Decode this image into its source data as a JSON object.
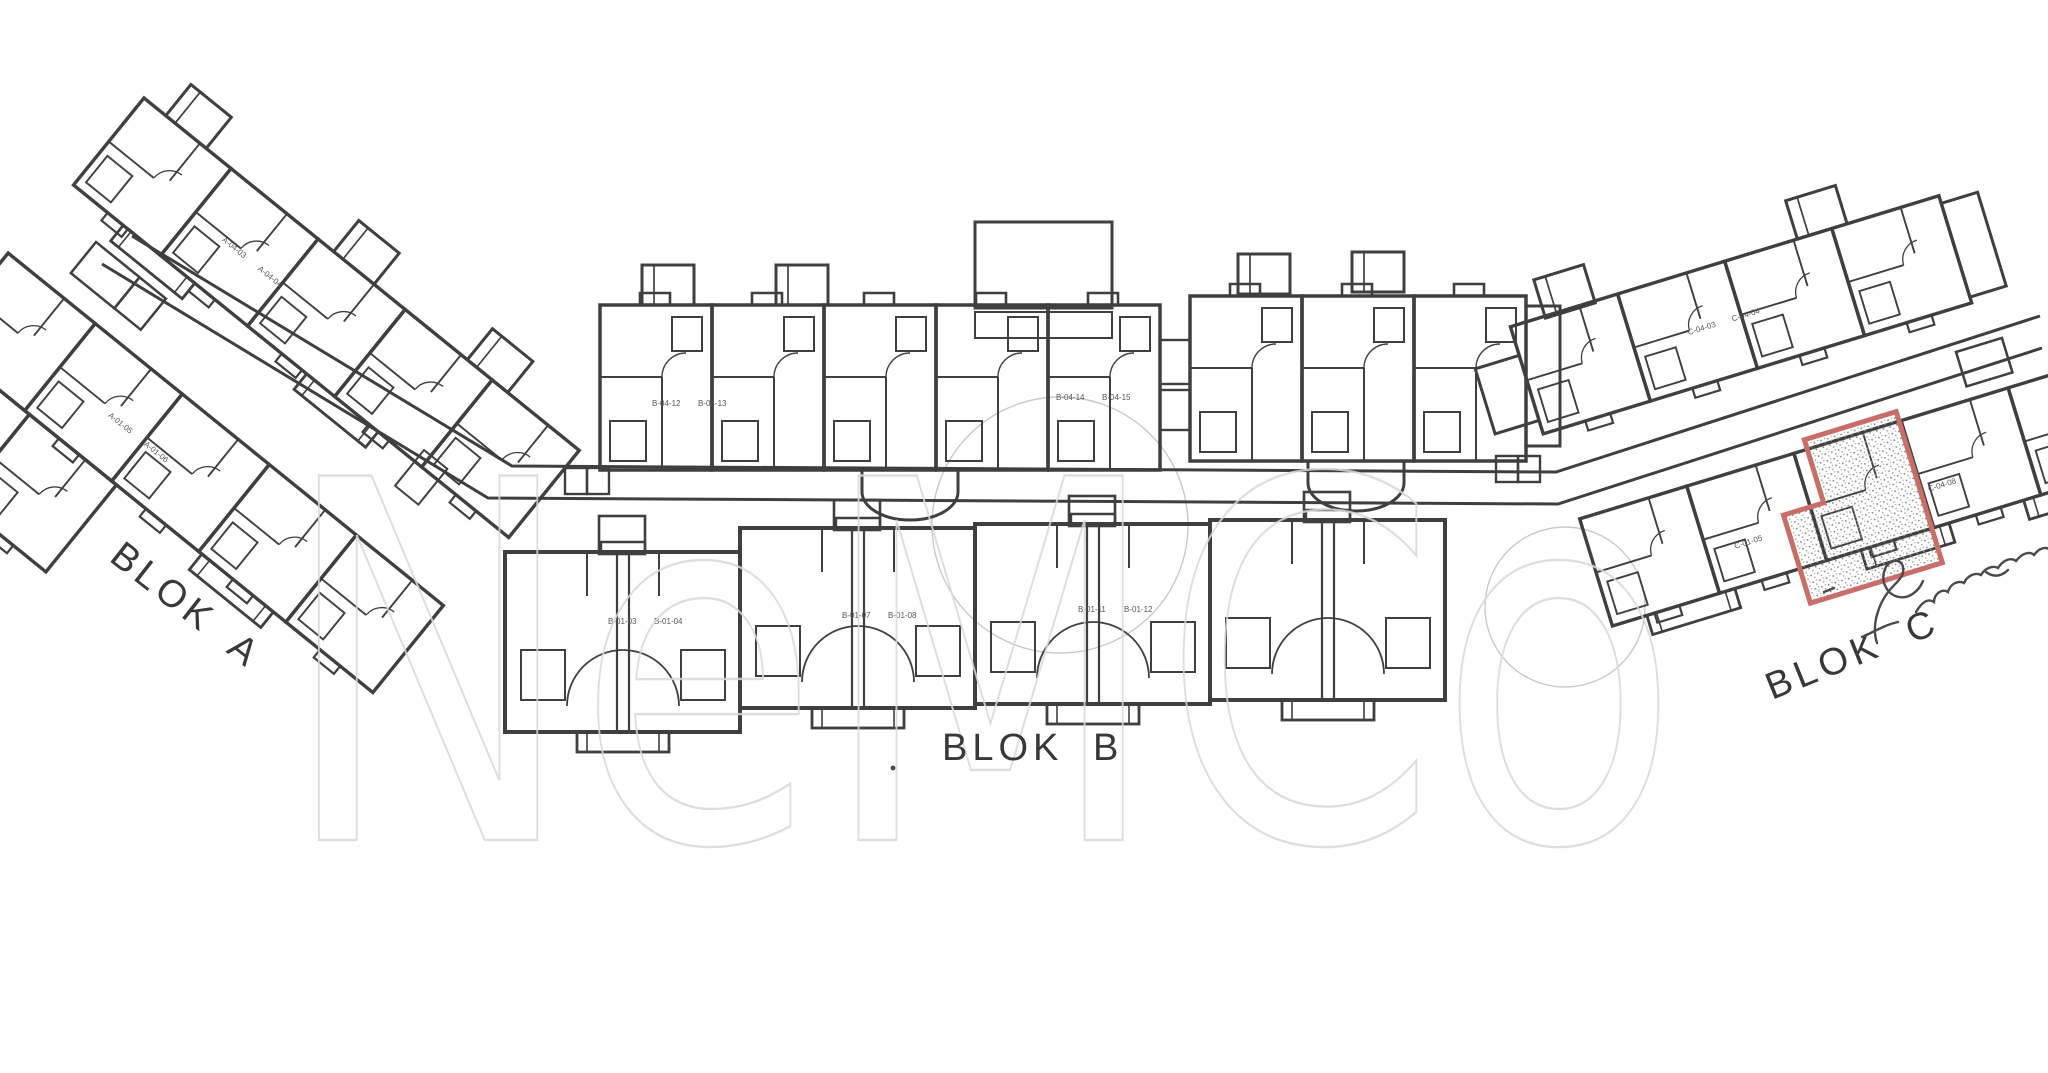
{
  "labels": {
    "blok_a": "BLOK A",
    "blok_b": "BLOK B",
    "blok_c": "BLOK C"
  },
  "watermark": {
    "text": "NeMCo",
    "color": "#d9d9d9"
  },
  "highlight": {
    "outline_color": "#c96d69",
    "unit_label": "C-04-08"
  },
  "units": {
    "b_top": [
      "B-04-12",
      "B-04-13",
      "B-04-14",
      "B-04-15"
    ],
    "b_bottom": [
      "B-01-03",
      "B-01-04",
      "B-01-07",
      "B-01-08",
      "B-01-11",
      "B-01-12"
    ],
    "a_wing1": [
      "A-04-03",
      "A-04-04"
    ],
    "a_wing2": [
      "A-01-05",
      "A-01-06"
    ],
    "c_upper": [
      "C-04-03",
      "C-04-04"
    ],
    "c_lower": [
      "C-01-05"
    ]
  },
  "colors": {
    "wall": "#3f3f3f",
    "faint_line": "#c9c9c9",
    "label": "#383838"
  }
}
